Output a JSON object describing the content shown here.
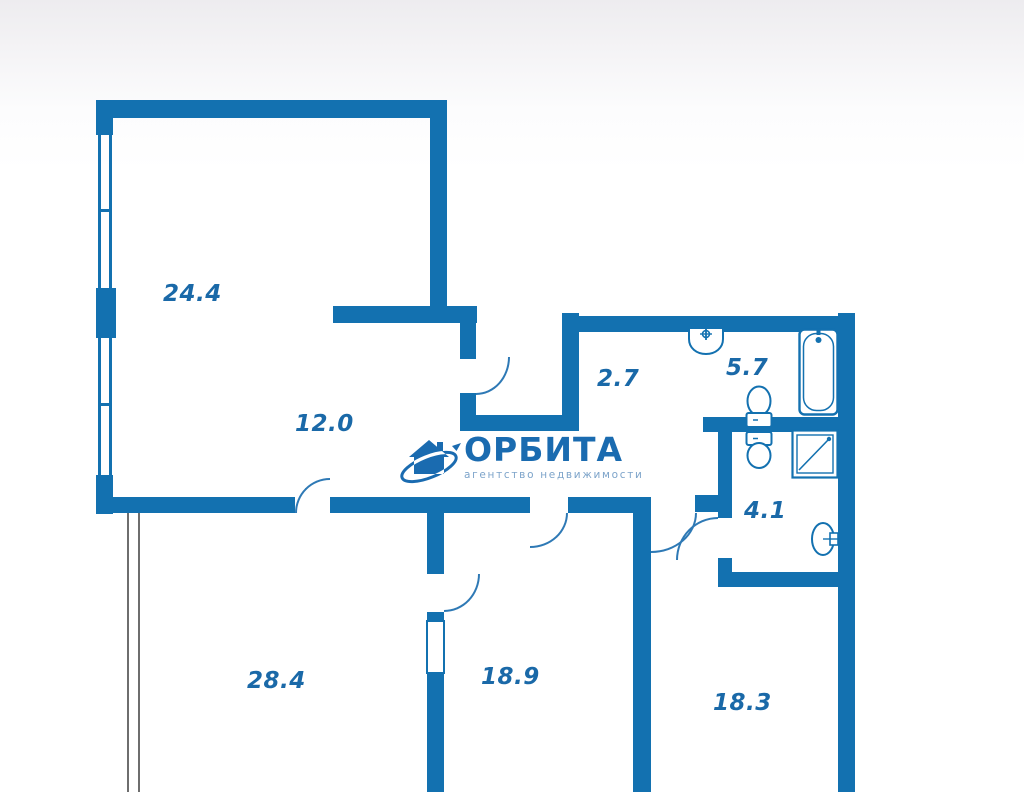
{
  "logo": {
    "name": "ОРБИТА",
    "tagline": "агентство недвижимости",
    "icon": "house-orbit-icon"
  },
  "rooms": [
    {
      "name": "living-room",
      "area": "24.4"
    },
    {
      "name": "hall",
      "area": "12.0"
    },
    {
      "name": "corridor",
      "area": "2.7"
    },
    {
      "name": "bathroom",
      "area": "5.7"
    },
    {
      "name": "wc",
      "area": "4.1"
    },
    {
      "name": "bedroom-1",
      "area": "28.4"
    },
    {
      "name": "bedroom-2",
      "area": "18.9"
    },
    {
      "name": "bedroom-3",
      "area": "18.3"
    }
  ],
  "fixtures": [
    "sink",
    "bathtub",
    "toilet",
    "toilet",
    "shower",
    "sink"
  ],
  "colors": {
    "wall": "#1371b0",
    "room_label": "#1a69a8",
    "logo_text": "#1a6bb0",
    "logo_tagline": "#7da4ca",
    "background_top": "#edecef",
    "background": "#ffffff"
  }
}
